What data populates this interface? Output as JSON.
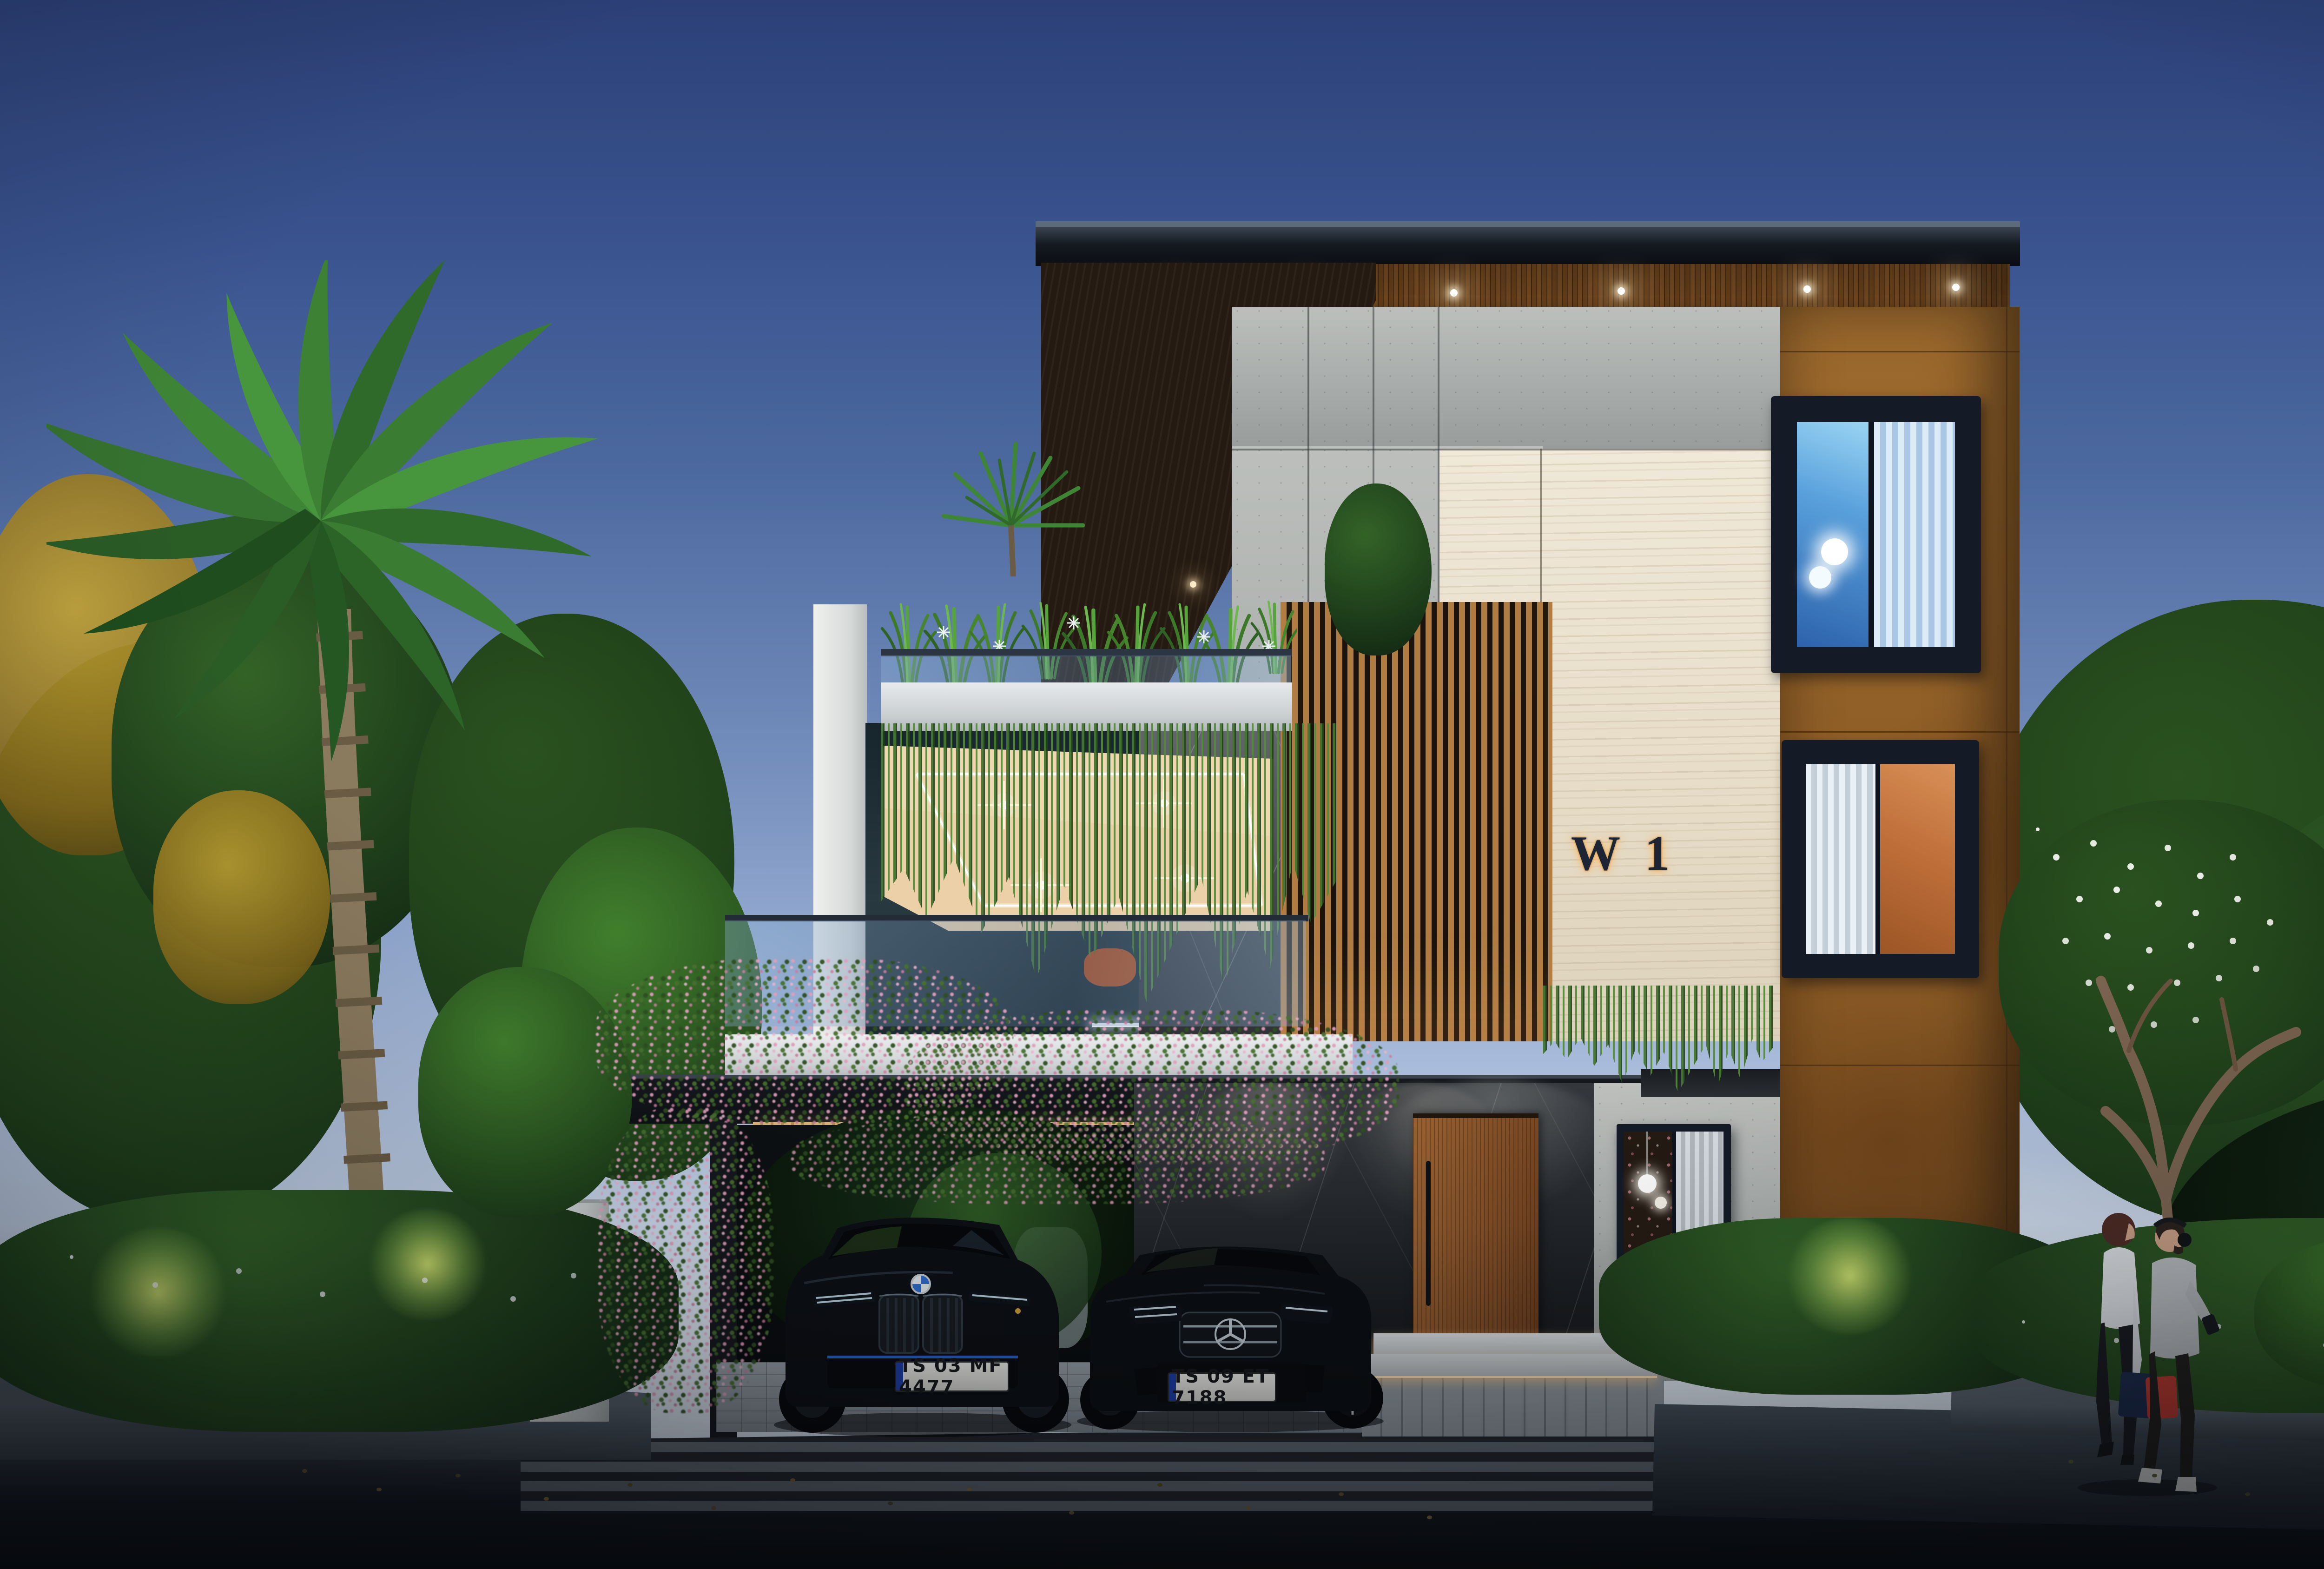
{
  "scene": {
    "type": "architectural-exterior-render",
    "time_of_day": "dusk",
    "subject": "modern three-storey villa with carport, roof garden and tropical landscaping"
  },
  "building": {
    "sign_text": "W 1",
    "floors": 3,
    "lighting": {
      "soffit_downlights": 6,
      "terrace_star_lights": 4,
      "step_led_strips": 2,
      "garage_wall_washers": 2
    }
  },
  "vehicles": [
    {
      "name": "black-suv",
      "brand_icon": "bmw-roundel-icon",
      "license_plate": "TS 03 MF 4477"
    },
    {
      "name": "black-sedan",
      "brand_icon": "mercedes-star-icon",
      "license_plate": "TS 09 ET 7188"
    }
  ],
  "people": [
    {
      "name": "woman-walking",
      "carrying": [
        "navy-shopping-bag",
        "red-shopping-bag"
      ]
    },
    {
      "name": "man-walking",
      "wearing": "headphones-icon"
    }
  ],
  "colors": {
    "sky_top": "#2c4077",
    "sky_horizon": "#e3eaf4",
    "corten_wall": "#9d6a2e",
    "travertine_wall": "#e9e0cd",
    "concrete_wall": "#b2b6b3",
    "dark_marble": "#26292e",
    "wood_soffit": "#7c4e24",
    "warm_light": "#ffd9a0",
    "window_frame": "#141b26",
    "asphalt": "#12161c"
  }
}
